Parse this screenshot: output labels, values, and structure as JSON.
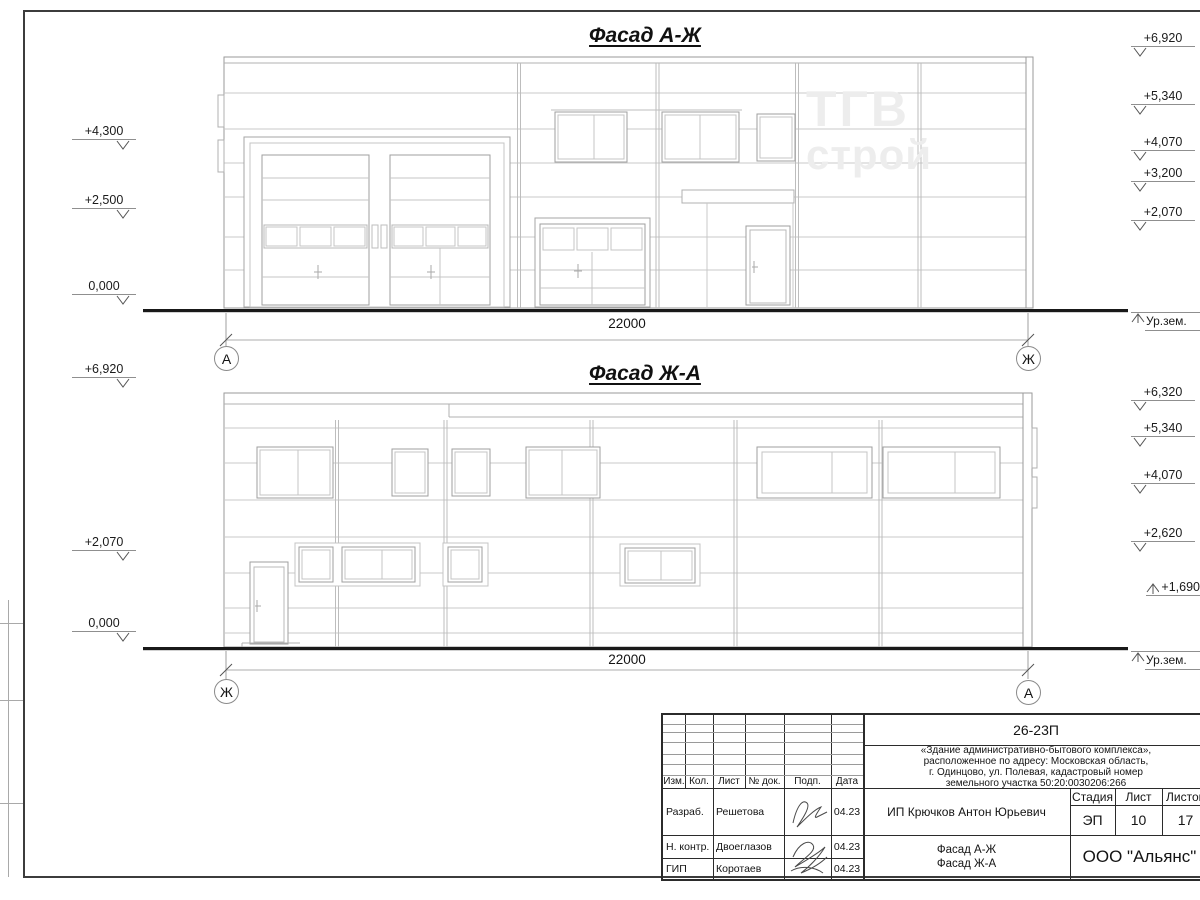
{
  "sheet": {
    "facades": [
      {
        "title": "Фасад А-Ж",
        "dimension": "22000",
        "axis_left": "А",
        "axis_right": "Ж",
        "ground_label": "Ур.зем.",
        "left_marks": [
          "+4,300",
          "+2,500",
          "0,000"
        ],
        "right_marks": [
          "+6,920",
          "+5,340",
          "+4,070",
          "+3,200",
          "+2,070"
        ]
      },
      {
        "title": "Фасад Ж-А",
        "dimension": "22000",
        "axis_left": "Ж",
        "axis_right": "А",
        "ground_label": "Ур.зем.",
        "left_marks": [
          "+6,920",
          "+2,070",
          "0,000"
        ],
        "right_marks": [
          "+6,320",
          "+5,340",
          "+4,070",
          "+2,620"
        ],
        "up_mark": "+1,690"
      }
    ],
    "watermark": {
      "line1": "ТГВ",
      "line2": "строй"
    },
    "title_block": {
      "doc_number": "26-23П",
      "description": "«Здание административно-бытового комплекса»,\nрасположенное по адресу: Московская область,\nг. Одинцово, ул. Полевая, кадастровый номер\nземельного участка 50:20:0030206:266",
      "columns": [
        "Изм.",
        "Кол.",
        "Лист",
        "№ док.",
        "Подп.",
        "Дата"
      ],
      "rows": [
        {
          "role": "Разраб.",
          "name": "Решетова",
          "date": "04.23"
        },
        {
          "role": "Н. контр.",
          "name": "Двоеглазов",
          "date": "04.23"
        },
        {
          "role": "ГИП",
          "name": "Коротаев",
          "date": "04.23"
        }
      ],
      "client": "ИП Крючков Антон Юрьевич",
      "stage_label": "Стадия",
      "sheet_label": "Лист",
      "sheets_label": "Листов",
      "stage": "ЭП",
      "sheet": "10",
      "sheets": "17",
      "drawing_title": "Фасад А-Ж\nФасад Ж-А",
      "company": "ООО \"Альянс\""
    }
  }
}
